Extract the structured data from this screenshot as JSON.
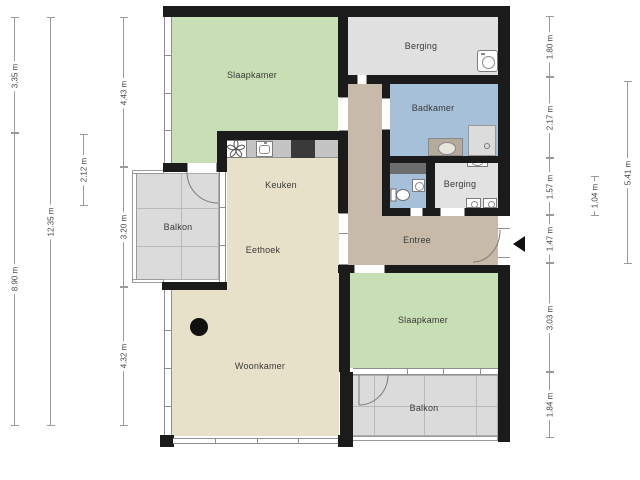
{
  "rooms": {
    "slaapkamer_1": "Slaapkamer",
    "berging_1": "Berging",
    "badkamer": "Badkamer",
    "keuken": "Keuken",
    "balkon_1": "Balkon",
    "eethoek": "Eethoek",
    "berging_2": "Berging",
    "entree": "Entree",
    "slaapkamer_2": "Slaapkamer",
    "woonkamer": "Woonkamer",
    "balkon_2": "Balkon"
  },
  "dimensions": {
    "left": {
      "col1": [
        "3.35 m",
        "8.90 m"
      ],
      "col2": [
        "12.35 m"
      ],
      "col3": [
        "2.12 m"
      ],
      "col4": [
        "4.43 m",
        "3.20 m",
        "4.32 m"
      ]
    },
    "right": {
      "col1": [
        "1.80 m",
        "2.17 m",
        "1.57 m",
        "1.47 m",
        "3.03 m",
        "1.84 m"
      ],
      "col2": [
        "1.04 m"
      ],
      "col3": [
        "5.41 m"
      ]
    }
  },
  "colors": {
    "room_green": "#c8dfb5",
    "room_tan": "#e8e1ca",
    "room_brown": "#c8baa8",
    "room_blue": "#a6c0d9",
    "storage_gray": "#e0e0e0",
    "balcony_gray": "#dbdbdb",
    "wall_black": "#1b1b1b",
    "counter_gray": "#c4c4c4",
    "cabinet_dark": "#3a3a3a",
    "shaft_gray": "#6d6d6d",
    "dim_line": "#9a9a9a",
    "dim_text": "#454545"
  }
}
